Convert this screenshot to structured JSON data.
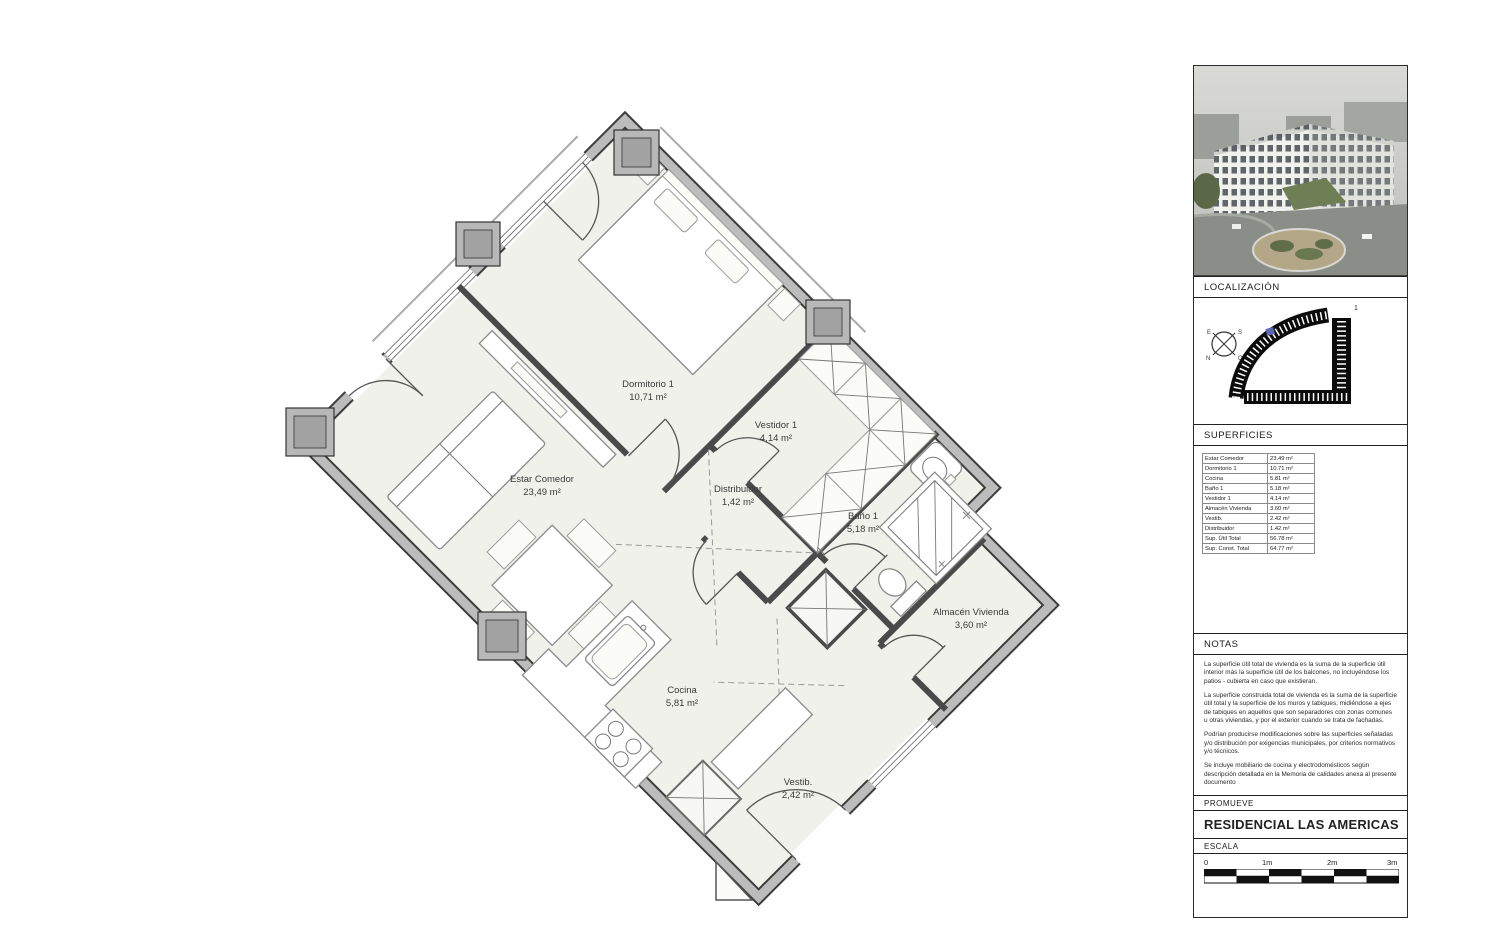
{
  "plan": {
    "rooms": [
      {
        "name": "Dormitorio 1",
        "area": "10,71 m²"
      },
      {
        "name": "Vestidor 1",
        "area": "4,14 m²"
      },
      {
        "name": "Distribuidor",
        "area": "1,42 m²"
      },
      {
        "name": "Estar Comedor",
        "area": "23,49 m²"
      },
      {
        "name": "Baño 1",
        "area": "5,18 m²"
      },
      {
        "name": "Almacén Vivienda",
        "area": "3,60 m²"
      },
      {
        "name": "Cocina",
        "area": "5,81 m²"
      },
      {
        "name": "Vestib.",
        "area": "2,42 m²"
      }
    ]
  },
  "sidebar": {
    "localizacion_label": "LOCALIZACIÓN",
    "superficies_label": "SUPERFICIES",
    "notas_label": "NOTAS",
    "promueve_label": "PROMUEVE",
    "escala_label": "ESCALA",
    "promoter_name": "RESIDENCIAL LAS AMERICAS",
    "site_marker": "1",
    "compass": {
      "e": "E",
      "s": "S",
      "n": "N",
      "o": "O"
    },
    "table": {
      "rows": [
        {
          "label": "Estar Comedor",
          "value": "23.49 m²"
        },
        {
          "label": "Dormitorio 1",
          "value": "10.71 m²"
        },
        {
          "label": "Cocina",
          "value": "5.81 m²"
        },
        {
          "label": "Baño 1",
          "value": "5.18 m²"
        },
        {
          "label": "Vestidor 1",
          "value": "4.14 m²"
        },
        {
          "label": "Almacén Vivienda",
          "value": "3.60 m²"
        },
        {
          "label": "Vestib.",
          "value": "2.42 m²"
        },
        {
          "label": "Distribuidor",
          "value": "1.42 m²"
        },
        {
          "label": "Sup. Útil Total",
          "value": "56.78 m²"
        },
        {
          "label": "Sup. Const. Total",
          "value": "64.77 m²"
        }
      ]
    },
    "notas": [
      "La superficie útil total de vivienda es la suma de la superficie útil interior más la superficie útil de los balcones, no incluyéndose los patios - cubierta en caso que existieran.",
      "La superficie construida total de vivienda es la suma de la superficie útil total y la superficie de los muros y tabiques, midiéndose a ejes de tabiques en aquellos que son separadores con zonas comunes u otras viviendas, y por el exterior cuando se trata de fachadas.",
      "Podrían producirse modificaciones sobre las superficies señaladas y/o distribución por exigencias municipales, por criterios normativos y/o técnicos.",
      "Se incluye mobiliario de cocina y electrodomésticos según descripción detallada en la Memoria de calidades anexa al presente documento"
    ],
    "scale_ticks": [
      "0",
      "1m",
      "2m",
      "3m"
    ]
  },
  "colors": {
    "floor": "#f1f1ec",
    "wall_core": "#bcbcbc",
    "wall_edge": "#3d3d3d",
    "unit_marker": "#5b67b0"
  }
}
